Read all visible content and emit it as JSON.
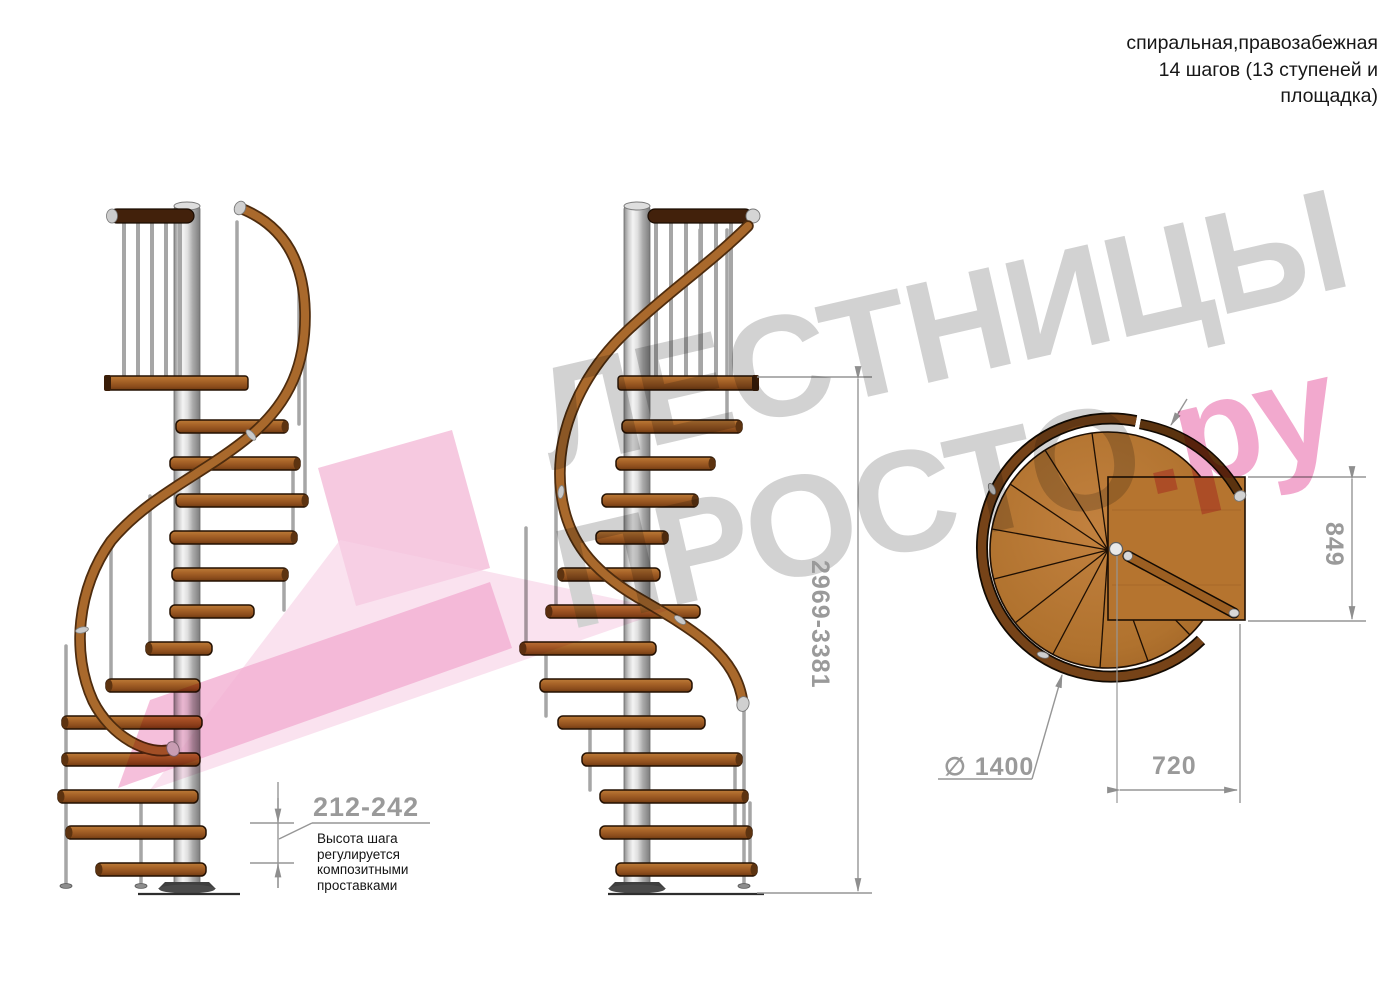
{
  "title": {
    "line1": "спиральная,правозабежная",
    "line2": "14 шагов (13 ступеней и",
    "line3": "площадка)"
  },
  "watermark": {
    "line1": "ЛЕСТНИЦЫ",
    "line2_gray": "ПРОСТО",
    "line2_pink": ".ру"
  },
  "dimensions": {
    "step_height": "212-242",
    "total_height": "2969-3381",
    "landing_depth": "849",
    "landing_width": "720",
    "diameter": "∅ 1400"
  },
  "note": {
    "line1": "Высота шага",
    "line2": "регулируется",
    "line3": "композитными",
    "line4": "проставками"
  },
  "colors": {
    "wood": "#a86428",
    "wood_dark": "#6f3a11",
    "handrail": "#a9692c",
    "pole": "#d9d9d9",
    "dimension_gray": "#9a9a9a",
    "text_black": "#171717",
    "watermark_gray": "#d2d2d2",
    "watermark_pink": "#f2a9ce"
  }
}
